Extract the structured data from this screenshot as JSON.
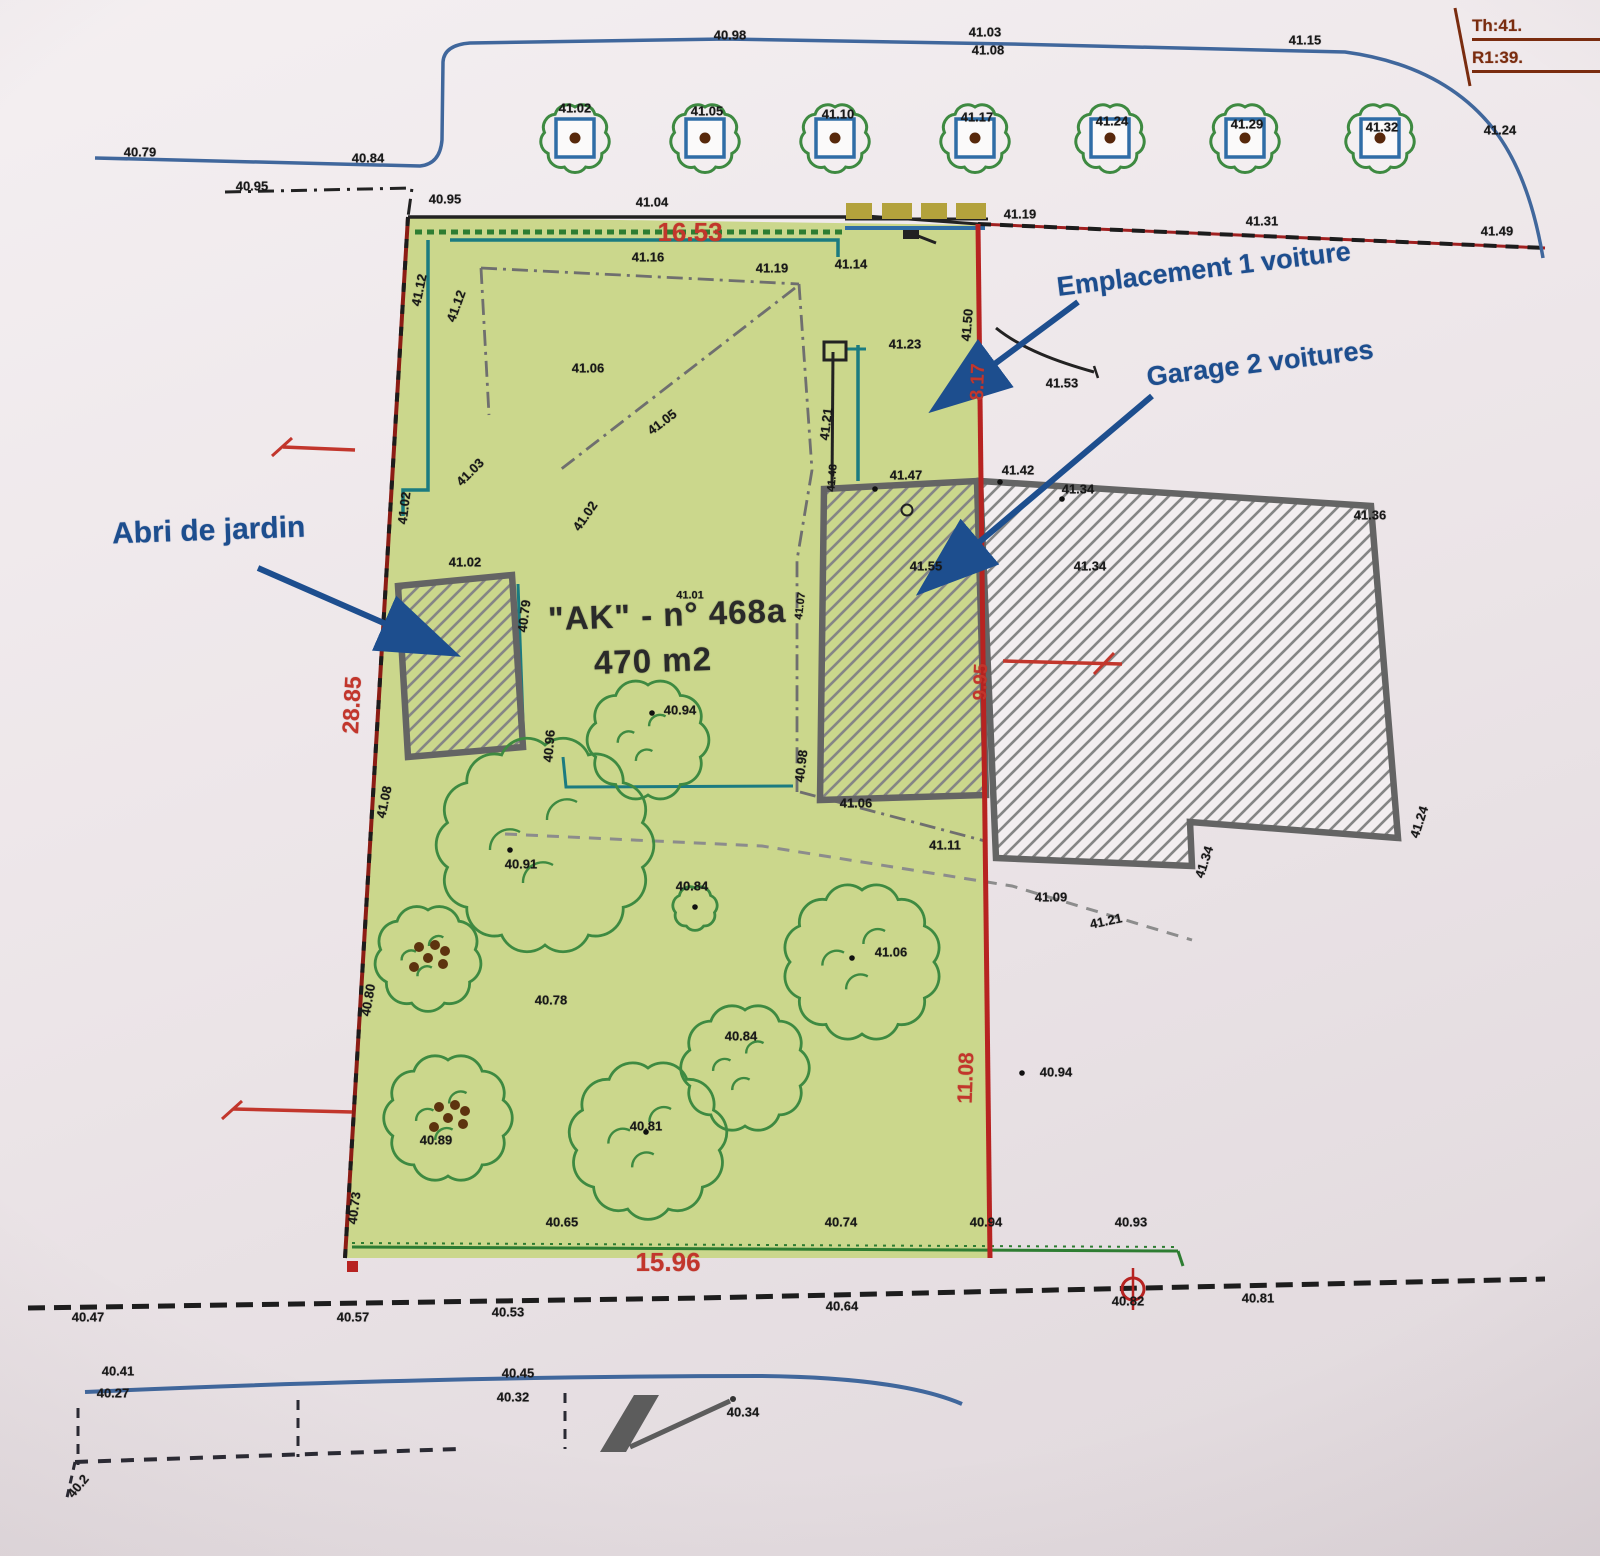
{
  "legend": {
    "line1": "Th:41.",
    "line2": "R1:39."
  },
  "callouts": {
    "shed": "Abri de jardin",
    "parking": "Emplacement 1 voiture",
    "garage": "Garage 2 voitures"
  },
  "parcel": {
    "id": "\"AK\" - n° 468a",
    "area": "470 m2"
  },
  "dimensions": {
    "top": "16.53",
    "left": "28.85",
    "right_upper": "8.17",
    "right_mid": "9.95",
    "right_lower": "11.08",
    "bottom": "15.96"
  },
  "colors": {
    "parcel_green": "#cbd78c",
    "boundary_red": "#b72321",
    "dimension_red": "#c2362c",
    "callout_blue": "#1d4e8e",
    "road_blue": "#40679c",
    "teal": "#1b7b80",
    "hedge_green": "#2e7d32",
    "building_gray": "#646464",
    "legend_brown": "#7a2c0f"
  },
  "labels": [
    {
      "t": "40.98",
      "x": 730,
      "y": 35
    },
    {
      "t": "41.03",
      "x": 985,
      "y": 32
    },
    {
      "t": "41.08",
      "x": 988,
      "y": 50
    },
    {
      "t": "41.15",
      "x": 1305,
      "y": 40
    },
    {
      "t": "41.24",
      "x": 1500,
      "y": 130
    },
    {
      "t": "41.02",
      "x": 575,
      "y": 108
    },
    {
      "t": "41.05",
      "x": 707,
      "y": 111
    },
    {
      "t": "41.10",
      "x": 838,
      "y": 114
    },
    {
      "t": "41.17",
      "x": 977,
      "y": 117
    },
    {
      "t": "41.24",
      "x": 1112,
      "y": 121
    },
    {
      "t": "41.29",
      "x": 1247,
      "y": 124
    },
    {
      "t": "41.32",
      "x": 1382,
      "y": 127
    },
    {
      "t": "40.79",
      "x": 140,
      "y": 152
    },
    {
      "t": "40.84",
      "x": 368,
      "y": 158
    },
    {
      "t": "40.95",
      "x": 252,
      "y": 186
    },
    {
      "t": "40.95",
      "x": 445,
      "y": 199
    },
    {
      "t": "41.04",
      "x": 652,
      "y": 202
    },
    {
      "t": "41.19",
      "x": 1020,
      "y": 214
    },
    {
      "t": "41.31",
      "x": 1262,
      "y": 221
    },
    {
      "t": "41.49",
      "x": 1497,
      "y": 231
    },
    {
      "t": "41.12",
      "x": 419,
      "y": 290,
      "r": -78
    },
    {
      "t": "41.12",
      "x": 456,
      "y": 306,
      "r": -70
    },
    {
      "t": "41.16",
      "x": 648,
      "y": 257
    },
    {
      "t": "41.19",
      "x": 772,
      "y": 268
    },
    {
      "t": "41.14",
      "x": 851,
      "y": 264
    },
    {
      "t": "41.06",
      "x": 588,
      "y": 368
    },
    {
      "t": "41.05",
      "x": 662,
      "y": 422,
      "r": -37
    },
    {
      "t": "41.23",
      "x": 905,
      "y": 344
    },
    {
      "t": "41.50",
      "x": 967,
      "y": 325,
      "r": -85
    },
    {
      "t": "41.21",
      "x": 826,
      "y": 424,
      "r": -83
    },
    {
      "t": "41.53",
      "x": 1062,
      "y": 383
    },
    {
      "t": "41.02",
      "x": 465,
      "y": 562
    },
    {
      "t": "40.79",
      "x": 524,
      "y": 616,
      "r": -83
    },
    {
      "t": "41.02",
      "x": 585,
      "y": 516,
      "r": -55
    },
    {
      "t": "41.03",
      "x": 470,
      "y": 472,
      "r": -45
    },
    {
      "t": "41.02",
      "x": 404,
      "y": 508,
      "r": -83
    },
    {
      "t": "41.01",
      "x": 690,
      "y": 596,
      "c": "sm"
    },
    {
      "t": "41.07",
      "x": 801,
      "y": 606,
      "r": -83,
      "c": "sm"
    },
    {
      "t": "40.96",
      "x": 549,
      "y": 746,
      "r": -85
    },
    {
      "t": "40.94",
      "x": 680,
      "y": 710
    },
    {
      "t": "41.08",
      "x": 384,
      "y": 802,
      "r": -78
    },
    {
      "t": "40.80",
      "x": 368,
      "y": 1000,
      "r": -80
    },
    {
      "t": "40.73",
      "x": 354,
      "y": 1208,
      "r": -83
    },
    {
      "t": "41.47",
      "x": 906,
      "y": 475
    },
    {
      "t": "41.42",
      "x": 1018,
      "y": 470
    },
    {
      "t": "41.34",
      "x": 1078,
      "y": 489
    },
    {
      "t": "41.55",
      "x": 926,
      "y": 566
    },
    {
      "t": "41.34",
      "x": 1090,
      "y": 566
    },
    {
      "t": "41.36",
      "x": 1370,
      "y": 515
    },
    {
      "t": "41.48",
      "x": 833,
      "y": 478,
      "r": -85,
      "c": "sm"
    },
    {
      "t": "41.24",
      "x": 1419,
      "y": 822,
      "r": -72
    },
    {
      "t": "41.34",
      "x": 1204,
      "y": 862,
      "r": -72
    },
    {
      "t": "41.06",
      "x": 856,
      "y": 803
    },
    {
      "t": "40.98",
      "x": 801,
      "y": 766,
      "r": -83
    },
    {
      "t": "41.11",
      "x": 945,
      "y": 845
    },
    {
      "t": "41.09",
      "x": 1051,
      "y": 897
    },
    {
      "t": "41.21",
      "x": 1106,
      "y": 921,
      "r": -12
    },
    {
      "t": "40.91",
      "x": 521,
      "y": 864
    },
    {
      "t": "40.84",
      "x": 692,
      "y": 886
    },
    {
      "t": "41.06",
      "x": 891,
      "y": 952
    },
    {
      "t": "40.78",
      "x": 551,
      "y": 1000
    },
    {
      "t": "40.84",
      "x": 741,
      "y": 1036
    },
    {
      "t": "40.81",
      "x": 646,
      "y": 1126
    },
    {
      "t": "40.89",
      "x": 436,
      "y": 1140
    },
    {
      "t": "40.94",
      "x": 1056,
      "y": 1072
    },
    {
      "t": "40.65",
      "x": 562,
      "y": 1222
    },
    {
      "t": "40.74",
      "x": 841,
      "y": 1222
    },
    {
      "t": "40.94",
      "x": 986,
      "y": 1222
    },
    {
      "t": "40.93",
      "x": 1131,
      "y": 1222
    },
    {
      "t": "40.47",
      "x": 88,
      "y": 1317
    },
    {
      "t": "40.57",
      "x": 353,
      "y": 1317
    },
    {
      "t": "40.53",
      "x": 508,
      "y": 1312
    },
    {
      "t": "40.64",
      "x": 842,
      "y": 1306
    },
    {
      "t": "40.82",
      "x": 1128,
      "y": 1301
    },
    {
      "t": "40.81",
      "x": 1258,
      "y": 1298
    },
    {
      "t": "40.41",
      "x": 118,
      "y": 1371
    },
    {
      "t": "40.27",
      "x": 113,
      "y": 1393
    },
    {
      "t": "40.45",
      "x": 518,
      "y": 1373
    },
    {
      "t": "40.32",
      "x": 513,
      "y": 1397
    },
    {
      "t": "40.34",
      "x": 743,
      "y": 1412
    },
    {
      "t": "40.2",
      "x": 78,
      "y": 1486,
      "r": -50
    }
  ]
}
